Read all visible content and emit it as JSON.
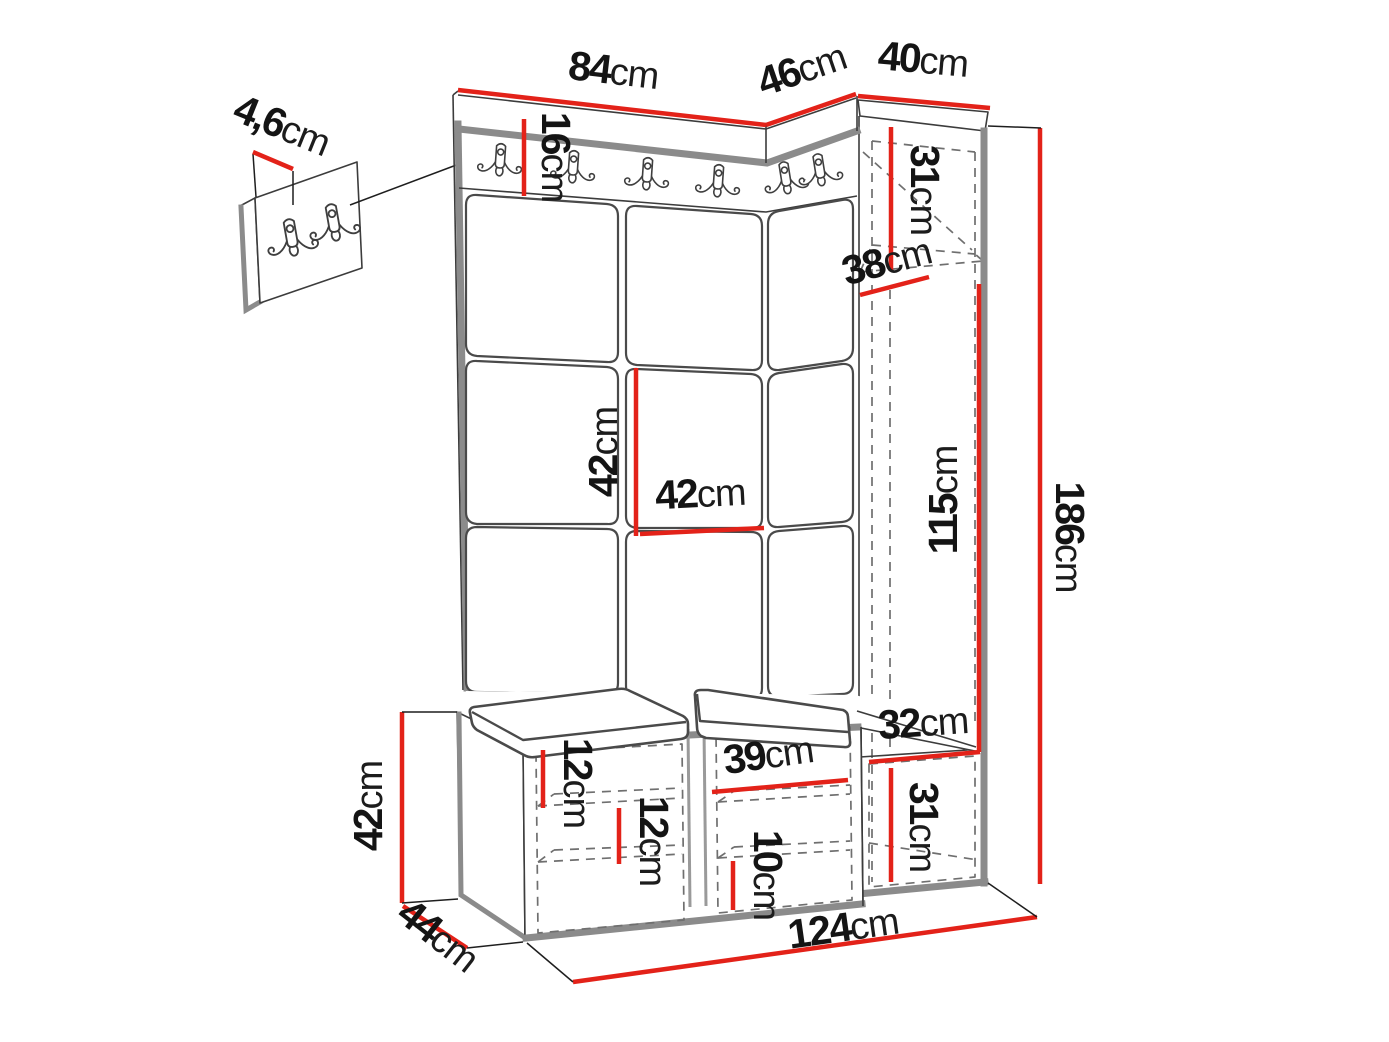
{
  "units": "cm",
  "colors": {
    "dimension_red": "#e32219",
    "edge_gray": "#8b8b8b",
    "outline_dark": "#3c3c3c",
    "background": "#ffffff"
  },
  "icons": {
    "coat_hook": "double-coat-hook-icon"
  },
  "dims": {
    "panel_thickness": {
      "value": "4,6",
      "unit": "cm"
    },
    "top_main_width": {
      "value": "84",
      "unit": "cm"
    },
    "top_corner_width": {
      "value": "46",
      "unit": "cm"
    },
    "top_cabinet_width": {
      "value": "40",
      "unit": "cm"
    },
    "hook_band_height": {
      "value": "16",
      "unit": "cm"
    },
    "cabinet_top_section_height": {
      "value": "31",
      "unit": "cm"
    },
    "cabinet_depth": {
      "value": "38",
      "unit": "cm"
    },
    "tile_height": {
      "value": "42",
      "unit": "cm"
    },
    "tile_width": {
      "value": "42",
      "unit": "cm"
    },
    "cabinet_interior_height": {
      "value": "115",
      "unit": "cm"
    },
    "total_height": {
      "value": "186",
      "unit": "cm"
    },
    "right_compartment_width": {
      "value": "32",
      "unit": "cm"
    },
    "right_door_height": {
      "value": "31",
      "unit": "cm"
    },
    "bench_shelf_gap_top": {
      "value": "12",
      "unit": "cm"
    },
    "bench_shelf_gap_mid": {
      "value": "12",
      "unit": "cm"
    },
    "bench_mid_width": {
      "value": "39",
      "unit": "cm"
    },
    "bench_bottom_gap": {
      "value": "10",
      "unit": "cm"
    },
    "bench_height": {
      "value": "42",
      "unit": "cm"
    },
    "bench_depth": {
      "value": "44",
      "unit": "cm"
    },
    "total_width": {
      "value": "124",
      "unit": "cm"
    }
  }
}
